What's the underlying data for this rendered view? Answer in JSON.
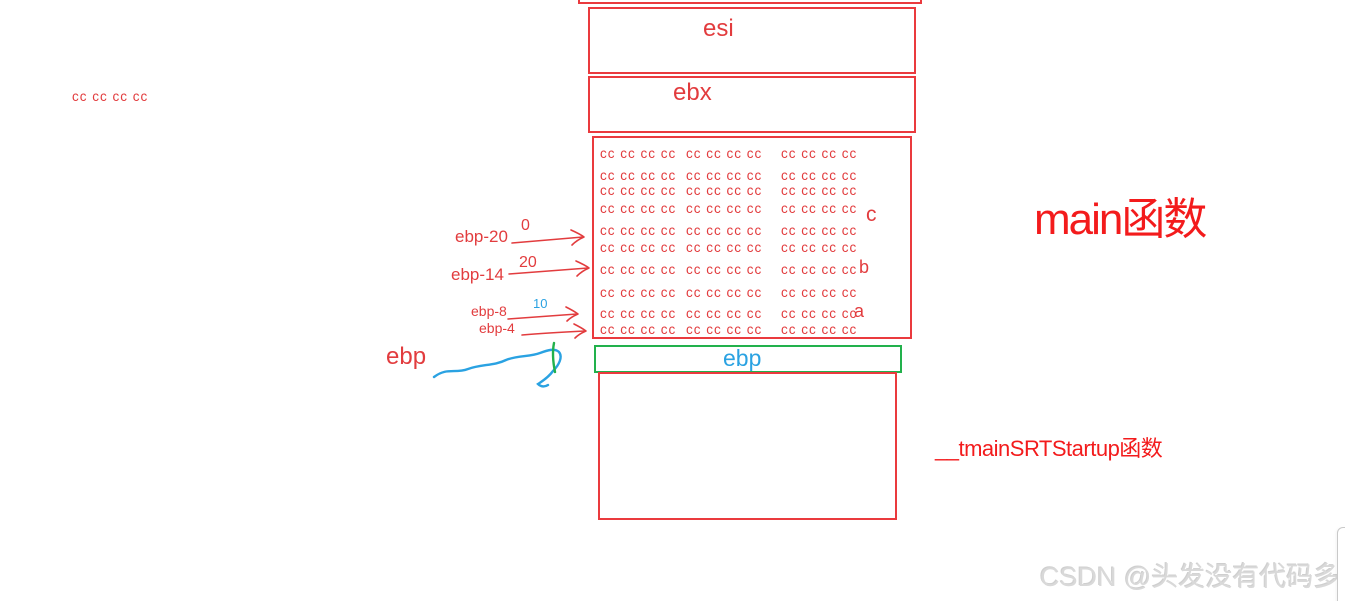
{
  "colors": {
    "red_border": "#ea3a3e",
    "red_text": "#e23c3e",
    "bright_red": "#f31b1c",
    "green": "#22b14c",
    "blue": "#2aa2e2",
    "watermark_gray": "#d9d9d9"
  },
  "registers": {
    "esi": "esi",
    "ebx": "ebx"
  },
  "ebp_slot": {
    "label": "ebp"
  },
  "floating_text": "cc cc cc cc",
  "stack": {
    "fill_pattern": "cc cc cc cc",
    "rows": [
      {
        "cols": [
          "cc cc cc cc",
          "cc cc cc cc",
          "cc cc cc cc"
        ],
        "var": ""
      },
      {
        "cols": [
          "cc cc cc cc",
          "cc cc cc cc",
          "cc cc cc cc"
        ],
        "var": ""
      },
      {
        "cols": [
          "cc cc cc cc",
          "cc cc cc cc",
          "cc cc cc cc"
        ],
        "var": ""
      },
      {
        "cols": [
          "cc cc cc cc",
          "cc cc cc cc",
          "cc cc cc cc"
        ],
        "var": "c"
      },
      {
        "cols": [
          "cc cc cc cc",
          "cc cc cc cc",
          "cc cc cc cc"
        ],
        "var": ""
      },
      {
        "cols": [
          "cc cc cc cc",
          "cc cc cc cc",
          "cc cc cc cc"
        ],
        "var": ""
      },
      {
        "cols": [
          "cc cc cc cc",
          "cc cc cc cc",
          "cc cc cc cc"
        ],
        "var": "b"
      },
      {
        "cols": [
          "cc cc cc cc",
          "cc cc cc cc",
          "cc cc cc cc"
        ],
        "var": ""
      },
      {
        "cols": [
          "cc cc cc cc",
          "cc cc cc cc",
          "cc cc cc cc"
        ],
        "var": "a"
      },
      {
        "cols": [
          "cc cc cc cc",
          "cc cc cc cc",
          "cc cc cc cc"
        ],
        "var": ""
      }
    ]
  },
  "pointer_labels": {
    "ebp20": "ebp-20",
    "ebp20_value": "0",
    "ebp14": "ebp-14",
    "ebp14_value": "20",
    "ebp8": "ebp-8",
    "ebp8_value": "10",
    "ebp4": "ebp-4",
    "ebp": "ebp"
  },
  "annotations": {
    "main_function": "main函数",
    "startup_function": "__tmainSRTStartup函数"
  },
  "watermark": "CSDN @头发没有代码多"
}
